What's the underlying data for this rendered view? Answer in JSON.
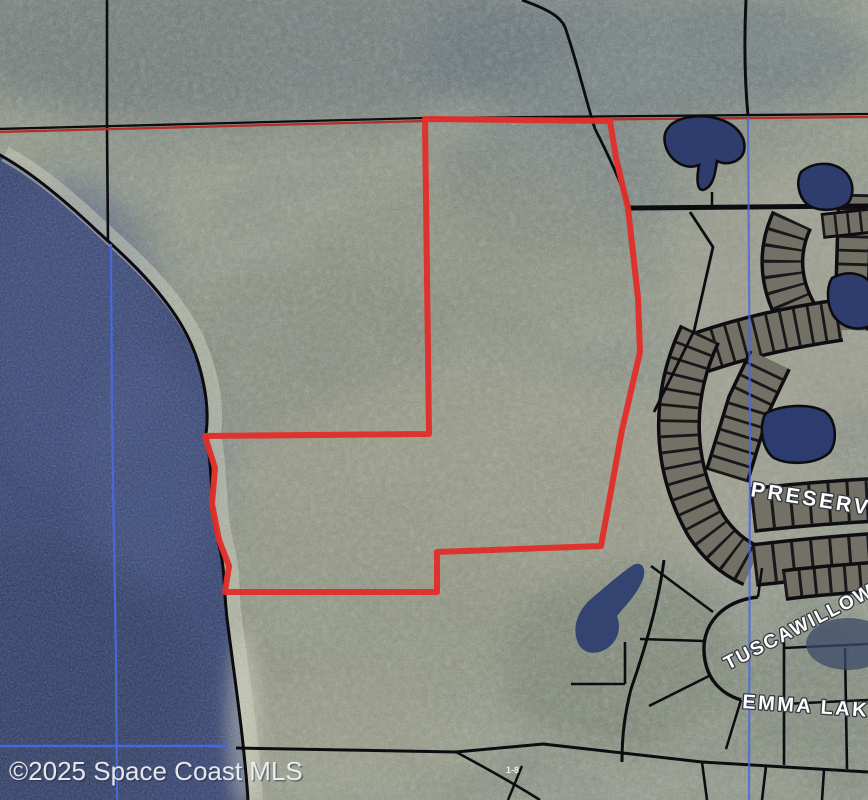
{
  "map": {
    "watermark": "©2025 Space Coast MLS",
    "labels": {
      "preserve": "PRESERVE",
      "tuscawillow": "TUSCAWILLOW",
      "emma_lake": "EMMA LAKE",
      "parcel_note": "1-8"
    },
    "colors": {
      "subject_boundary_red": "#e0302a",
      "section_line_red": "#b03028",
      "section_line_blue": "#4a67e0",
      "parcel_line_black": "#0d0d11",
      "water_navy": "#31406f",
      "land_base": "#78806e",
      "watermark_text": "#eef0f4",
      "label_white": "#ffffff"
    }
  }
}
